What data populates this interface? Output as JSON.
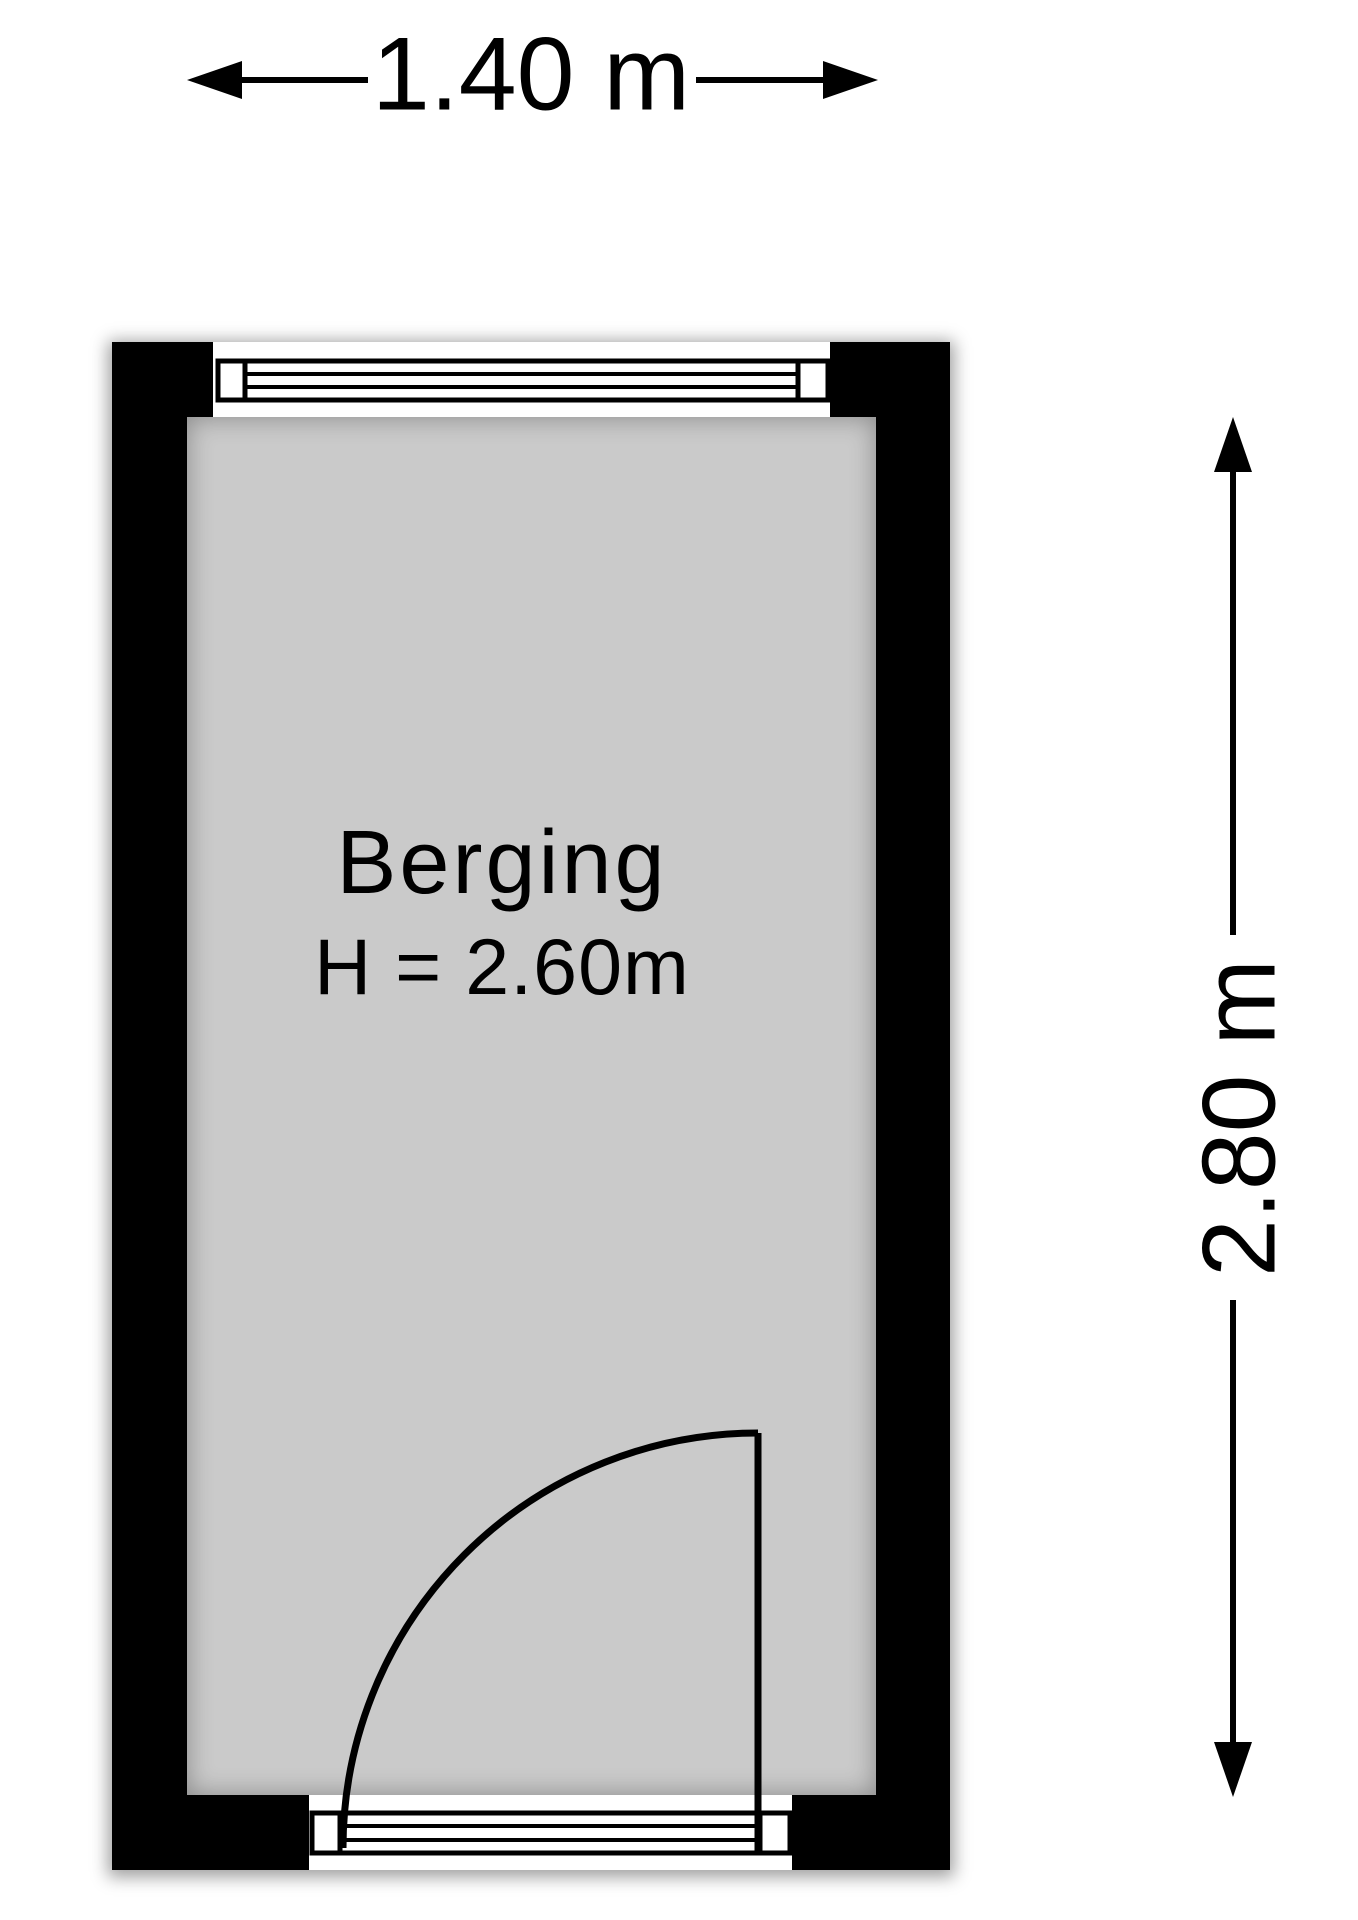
{
  "room": {
    "name": "Berging",
    "ceiling_height": "H = 2.60m"
  },
  "dimensions": {
    "width_label": "1.40 m",
    "height_label": "2.80 m"
  },
  "colors": {
    "wall": "#000000",
    "floor": "#cacaca",
    "outline": "#000000",
    "background": "#ffffff"
  },
  "icons": {
    "width_dimension": [
      "dimension-arrow-left-icon",
      "dimension-arrow-right-icon"
    ],
    "height_dimension": [
      "dimension-arrow-up-icon",
      "dimension-arrow-down-icon"
    ],
    "door": "door-swing-quarter-arc"
  }
}
